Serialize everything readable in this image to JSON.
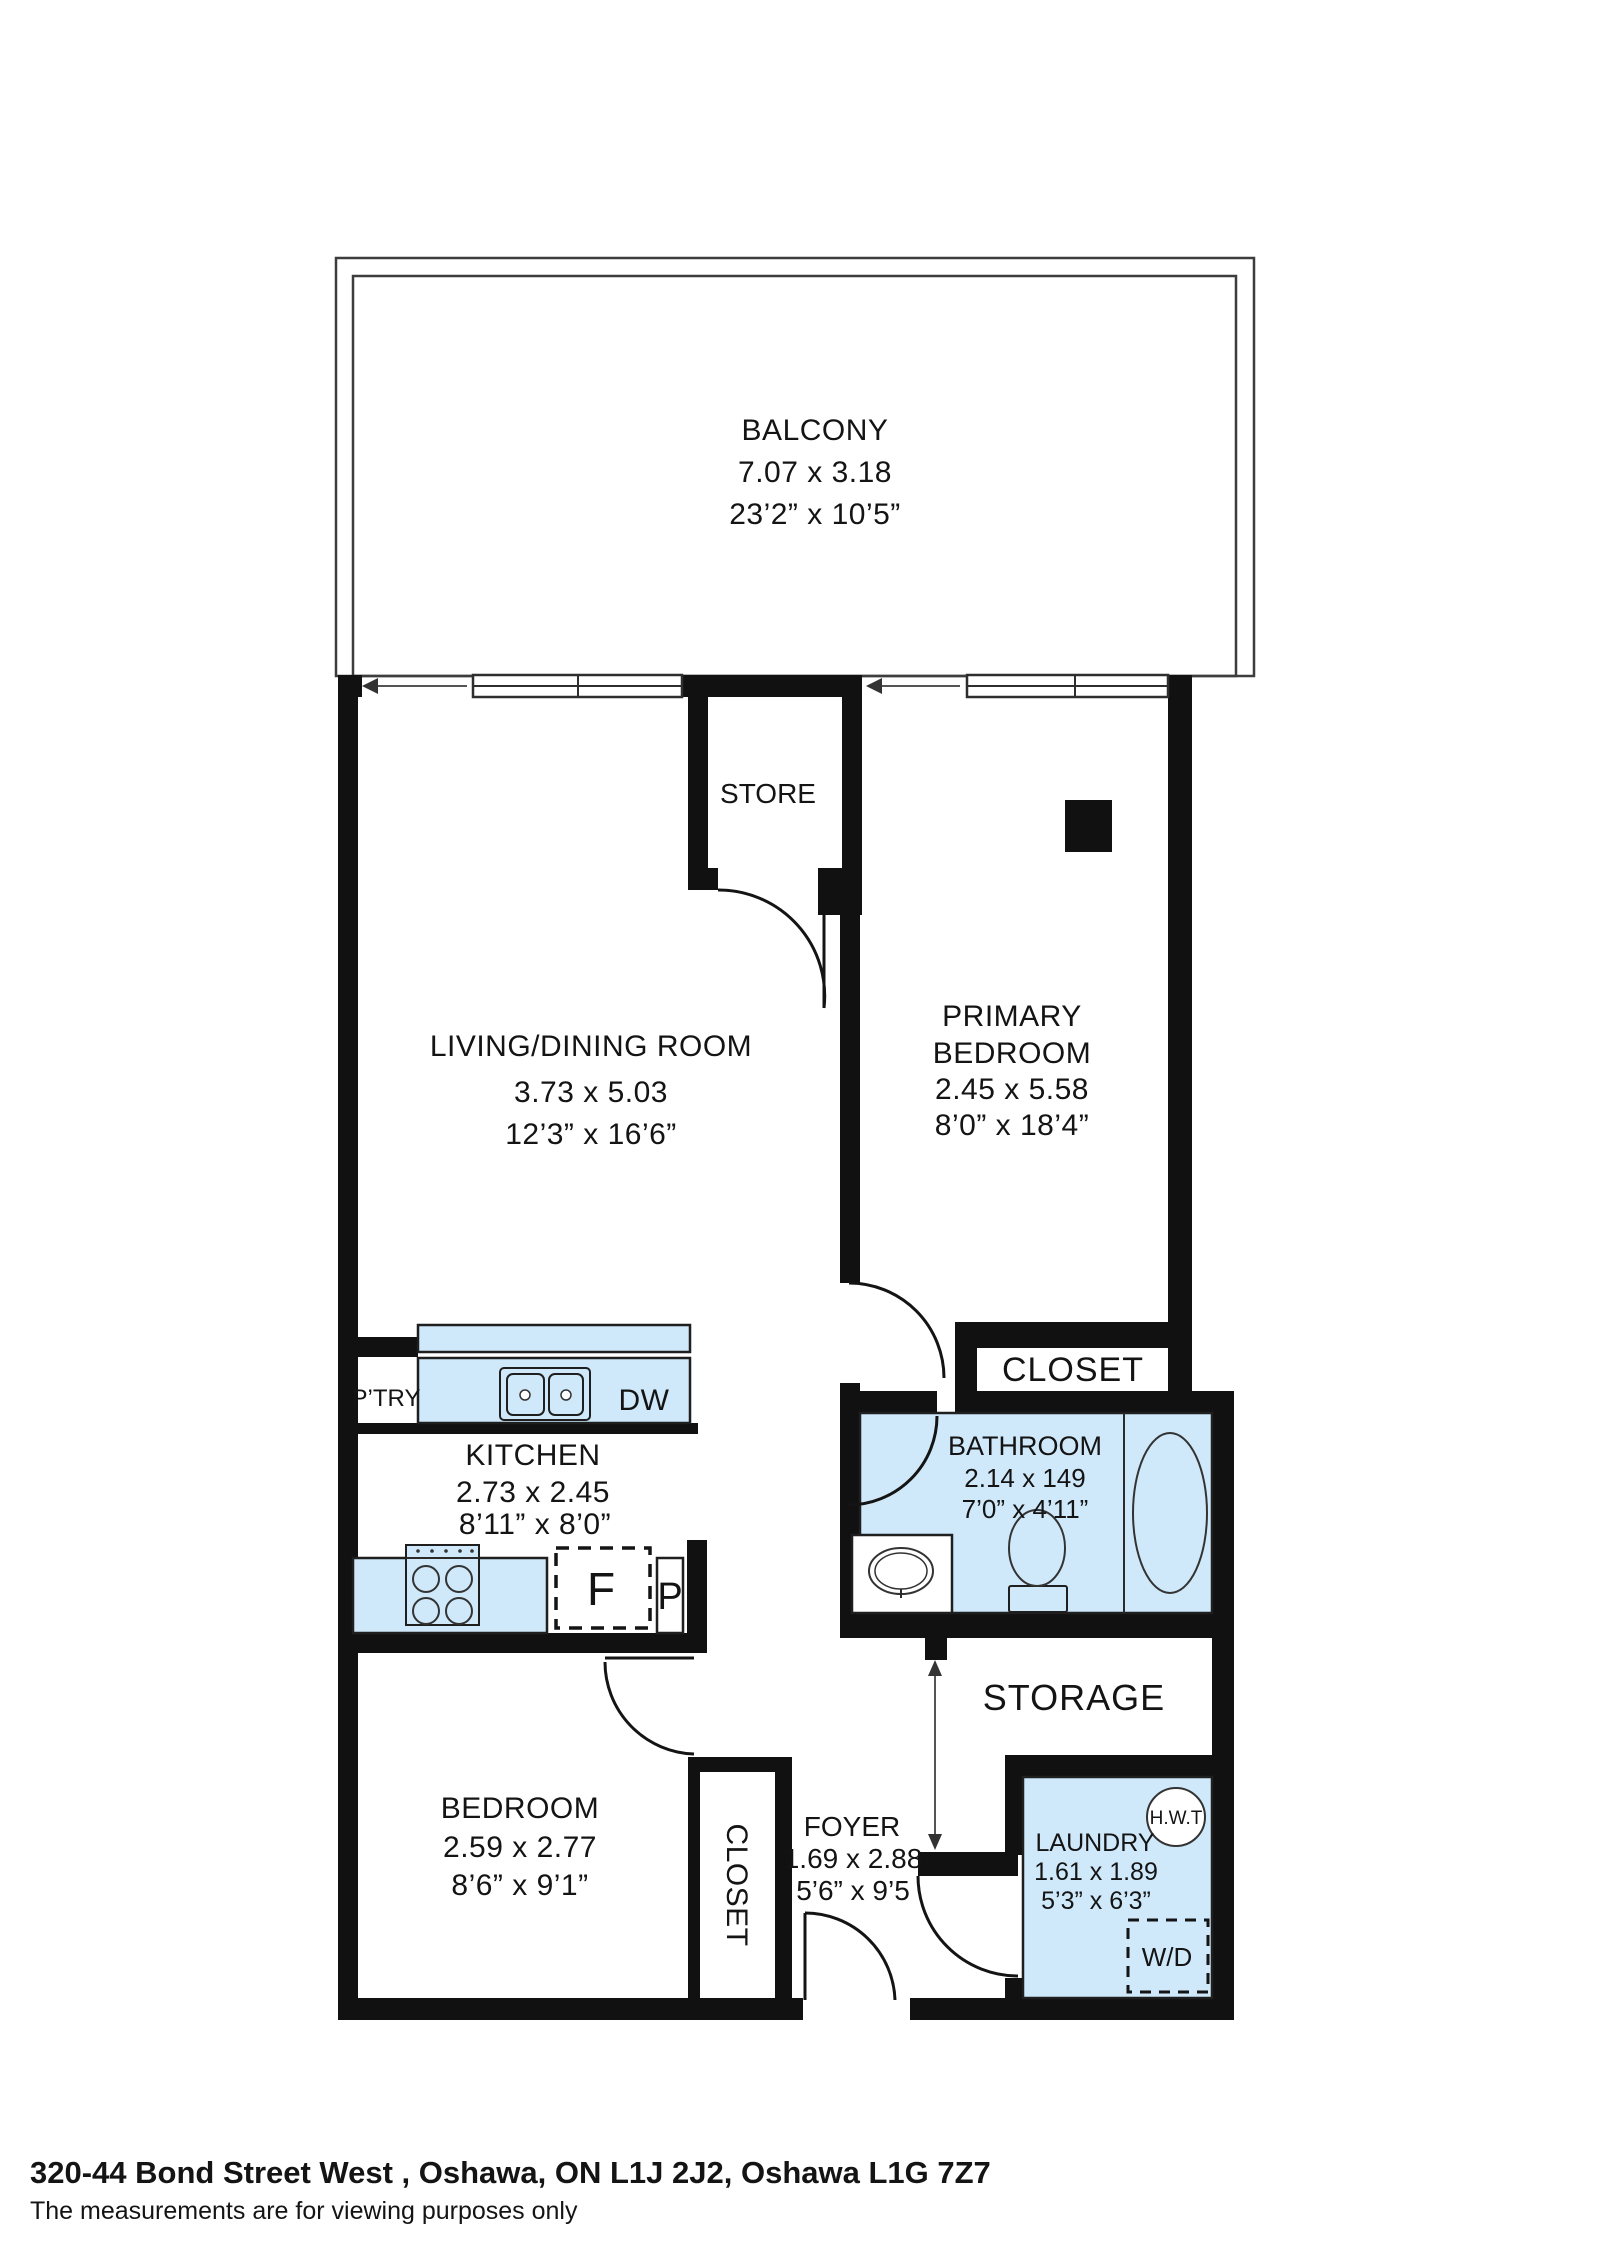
{
  "plan": {
    "balcony": {
      "name": "BALCONY",
      "metric": "7.07 x 3.18",
      "imperial": "23’2” x 10’5”"
    },
    "store": {
      "name": "STORE"
    },
    "living": {
      "name": "LIVING/DINING ROOM",
      "metric": "3.73 x 5.03",
      "imperial": "12’3” x 16’6”"
    },
    "primary": {
      "name_line1": "PRIMARY",
      "name_line2": "BEDROOM",
      "metric": "2.45 x 5.58",
      "imperial": "8’0” x 18’4”"
    },
    "closet_primary": {
      "name": "CLOSET"
    },
    "bathroom": {
      "name": "BATHROOM",
      "metric": "2.14 x 149",
      "imperial": "7’0” x 4’11”"
    },
    "kitchen": {
      "name": "KITCHEN",
      "metric": "2.73 x 2.45",
      "imperial": "8’11” x 8’0”",
      "pantry_label": "P’TRY",
      "dishwasher_label": "DW",
      "fridge_label": "F",
      "pantry_tall_label": "P"
    },
    "storage": {
      "name": "STORAGE"
    },
    "bedroom": {
      "name": "BEDROOM",
      "metric": "2.59 x 2.77",
      "imperial": "8’6” x 9’1”"
    },
    "closet_bedroom": {
      "name": "CLOSET"
    },
    "foyer": {
      "name": "FOYER",
      "metric": "1.69 x 2.88",
      "imperial": "5’6” x 9’5"
    },
    "laundry": {
      "name": "LAUNDRY",
      "metric": "1.61 x 1.89",
      "imperial": "5’3” x 6’3”",
      "hwt_label": "H.W.T",
      "wd_label": "W/D"
    }
  },
  "footer": {
    "address": "320-44 Bond Street West , Oshawa, ON L1J 2J2, Oshawa L1G 7Z7",
    "disclaimer": "The measurements are for viewing purposes only"
  },
  "colors": {
    "wall": "#111111",
    "fixture_fill": "#cfe9fa"
  }
}
